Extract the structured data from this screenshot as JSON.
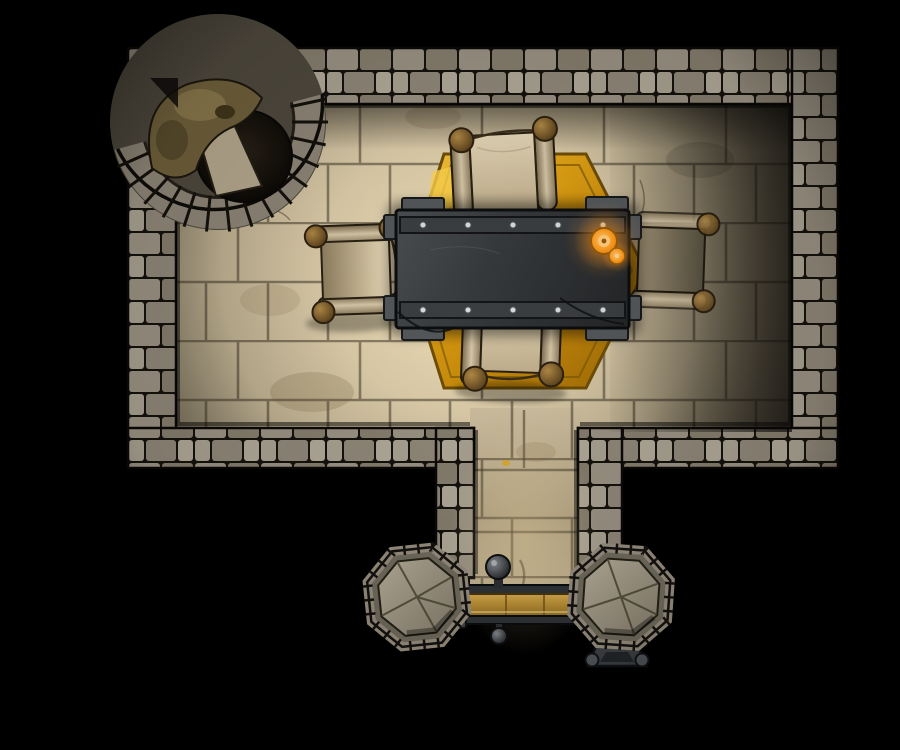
{
  "scene": {
    "map_label": "Top-down dungeon battle map: stone council chamber with iron table, scroll benches, gold hex rug, and a southern corridor ending at a barred wooden door",
    "room_label": "stone chamber floor",
    "walls_label": "stone block walls",
    "well_label": "collapsed round well alcove",
    "rug_label": "gold hexagonal rug",
    "table_label": "riveted iron council table",
    "candle_label": "lit candles on table",
    "bench_north_label": "scroll bench (north)",
    "bench_south_label": "scroll bench (south)",
    "bench_west_label": "scroll bench (west)",
    "bench_east_label": "scroll bench (east)",
    "corridor_label": "southern corridor",
    "door_label": "barred wooden door",
    "door_knob_label": "door knob",
    "door_pendant_label": "door pull",
    "pillar_left_label": "octagonal stone pillar (west)",
    "pillar_right_label": "octagonal stone pillar (east)",
    "mechanism_label": "iron floor bracket"
  },
  "palette": {
    "background": "#000000",
    "wall-stone-light": "#a8a191",
    "wall-stone-dark": "#857d6d",
    "wall-mortar": "#15120d",
    "floor-lit": "#ecdcb4",
    "floor-shadow": "#433e34",
    "rug-gold": "#e0a21b",
    "rug-gold-deep": "#a06c06",
    "table-iron": "#36393c",
    "parchment": "#d9cbac",
    "knob-brass": "#8a6a35",
    "candle-flame": "#fb9d1f",
    "door-wood": "#c89a3e",
    "pillar-stone": "#a89f8d",
    "well-hole": "#141109"
  }
}
